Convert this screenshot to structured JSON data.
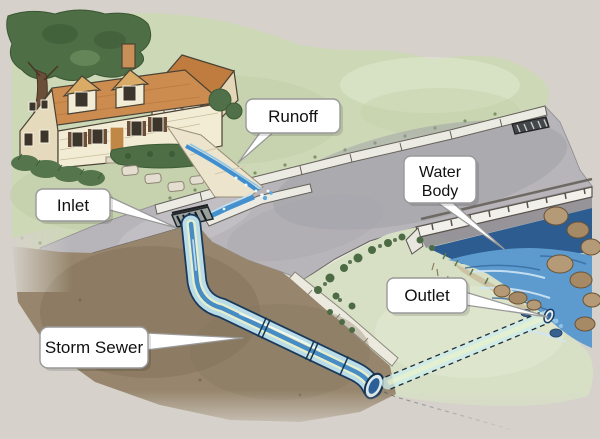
{
  "colors": {
    "background": "#d6d2cb",
    "grass": "#cdd8b6",
    "grass_bank": "#d7e0c5",
    "earth": "#97866d",
    "road": "#b7b5b9",
    "roof": "#cd8c4f",
    "house_wall": "#f3ecd4",
    "stream": "#5d9bcf",
    "pipe_water": "#3e86c4",
    "label_bg": "#ffffff",
    "label_border": "#999999",
    "label_text": "#111111"
  },
  "labels": {
    "runoff": {
      "text": "Runoff"
    },
    "inlet": {
      "text": "Inlet"
    },
    "water_body": {
      "line1": "Water",
      "line2": "Body"
    },
    "outlet": {
      "text": "Outlet"
    },
    "storm_sewer": {
      "text": "Storm Sewer"
    }
  }
}
